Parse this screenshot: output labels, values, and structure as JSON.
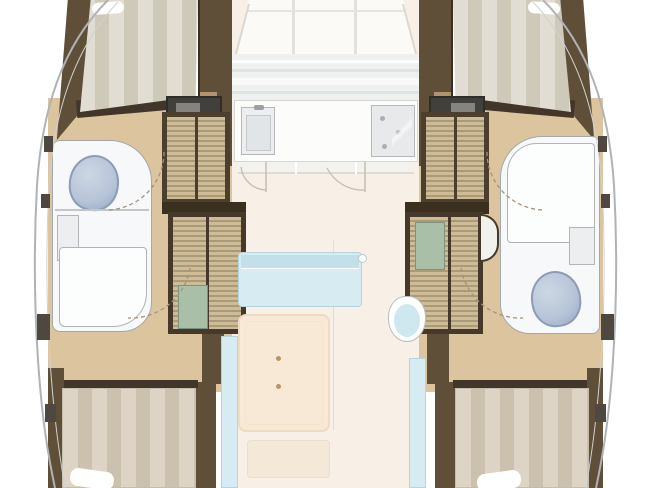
{
  "meta": {
    "subject": "catamaran-yacht-interior-floor-plan",
    "orientation": "bow-up"
  },
  "palette": {
    "hull_line": "#b0b3b5",
    "hull_line_inner": "#cfd1d2",
    "wall_brown": "#5f4f39",
    "wall_dark": "#42352a",
    "wood_trim": "#b1946a",
    "floor_wood": "#dcc49e",
    "slat_light": "#cdbc97",
    "slat_dark": "#ab9a77",
    "bed_stripe_light": "#e2ddd2",
    "bed_stripe_dark": "#cfc9ba",
    "bed_aft_light": "#ded4c5",
    "bed_aft_dark": "#ccc1ae",
    "bath_white": "#f7f8f9",
    "toilet_blue": "#b7c4d8",
    "toilet_shade": "#93a6c2",
    "saloon_floor": "#f8f0e6",
    "deck_white": "#fbfaf6",
    "windshield_gray": "#eff1f0",
    "counter_white": "#fcfcfb",
    "appliance_gray": "#e7e9ea",
    "sofa_blue": "#d7ecf2",
    "sofa_edge": "#b4d4de",
    "table_cream": "#f7e9d5",
    "bench_cream": "#f4e9d8",
    "glass_teal": "#a9bfa8",
    "arc_line": "#a5947a"
  },
  "regions": {
    "foredeck": {
      "label": "foredeck lockers"
    },
    "windshield": {
      "label": "coachroof windshield"
    },
    "galley": {
      "label": "galley",
      "fixtures": [
        "sink",
        "stove",
        "base cabinets"
      ]
    },
    "saloon": {
      "label": "saloon",
      "fixtures": [
        "sofa",
        "dining table",
        "swivel chair",
        "aft bench",
        "port settee",
        "starboard settee"
      ]
    },
    "port_hull": {
      "label": "port hull",
      "fixtures": [
        "forward berth",
        "overhead locker",
        "wardrobe",
        "toilet",
        "vanity sink",
        "shower",
        "aft berth"
      ]
    },
    "starboard_hull": {
      "label": "starboard hull",
      "fixtures": [
        "forward berth",
        "overhead locker",
        "wardrobe",
        "shower",
        "vanity sink",
        "toilet",
        "aft berth"
      ]
    }
  }
}
